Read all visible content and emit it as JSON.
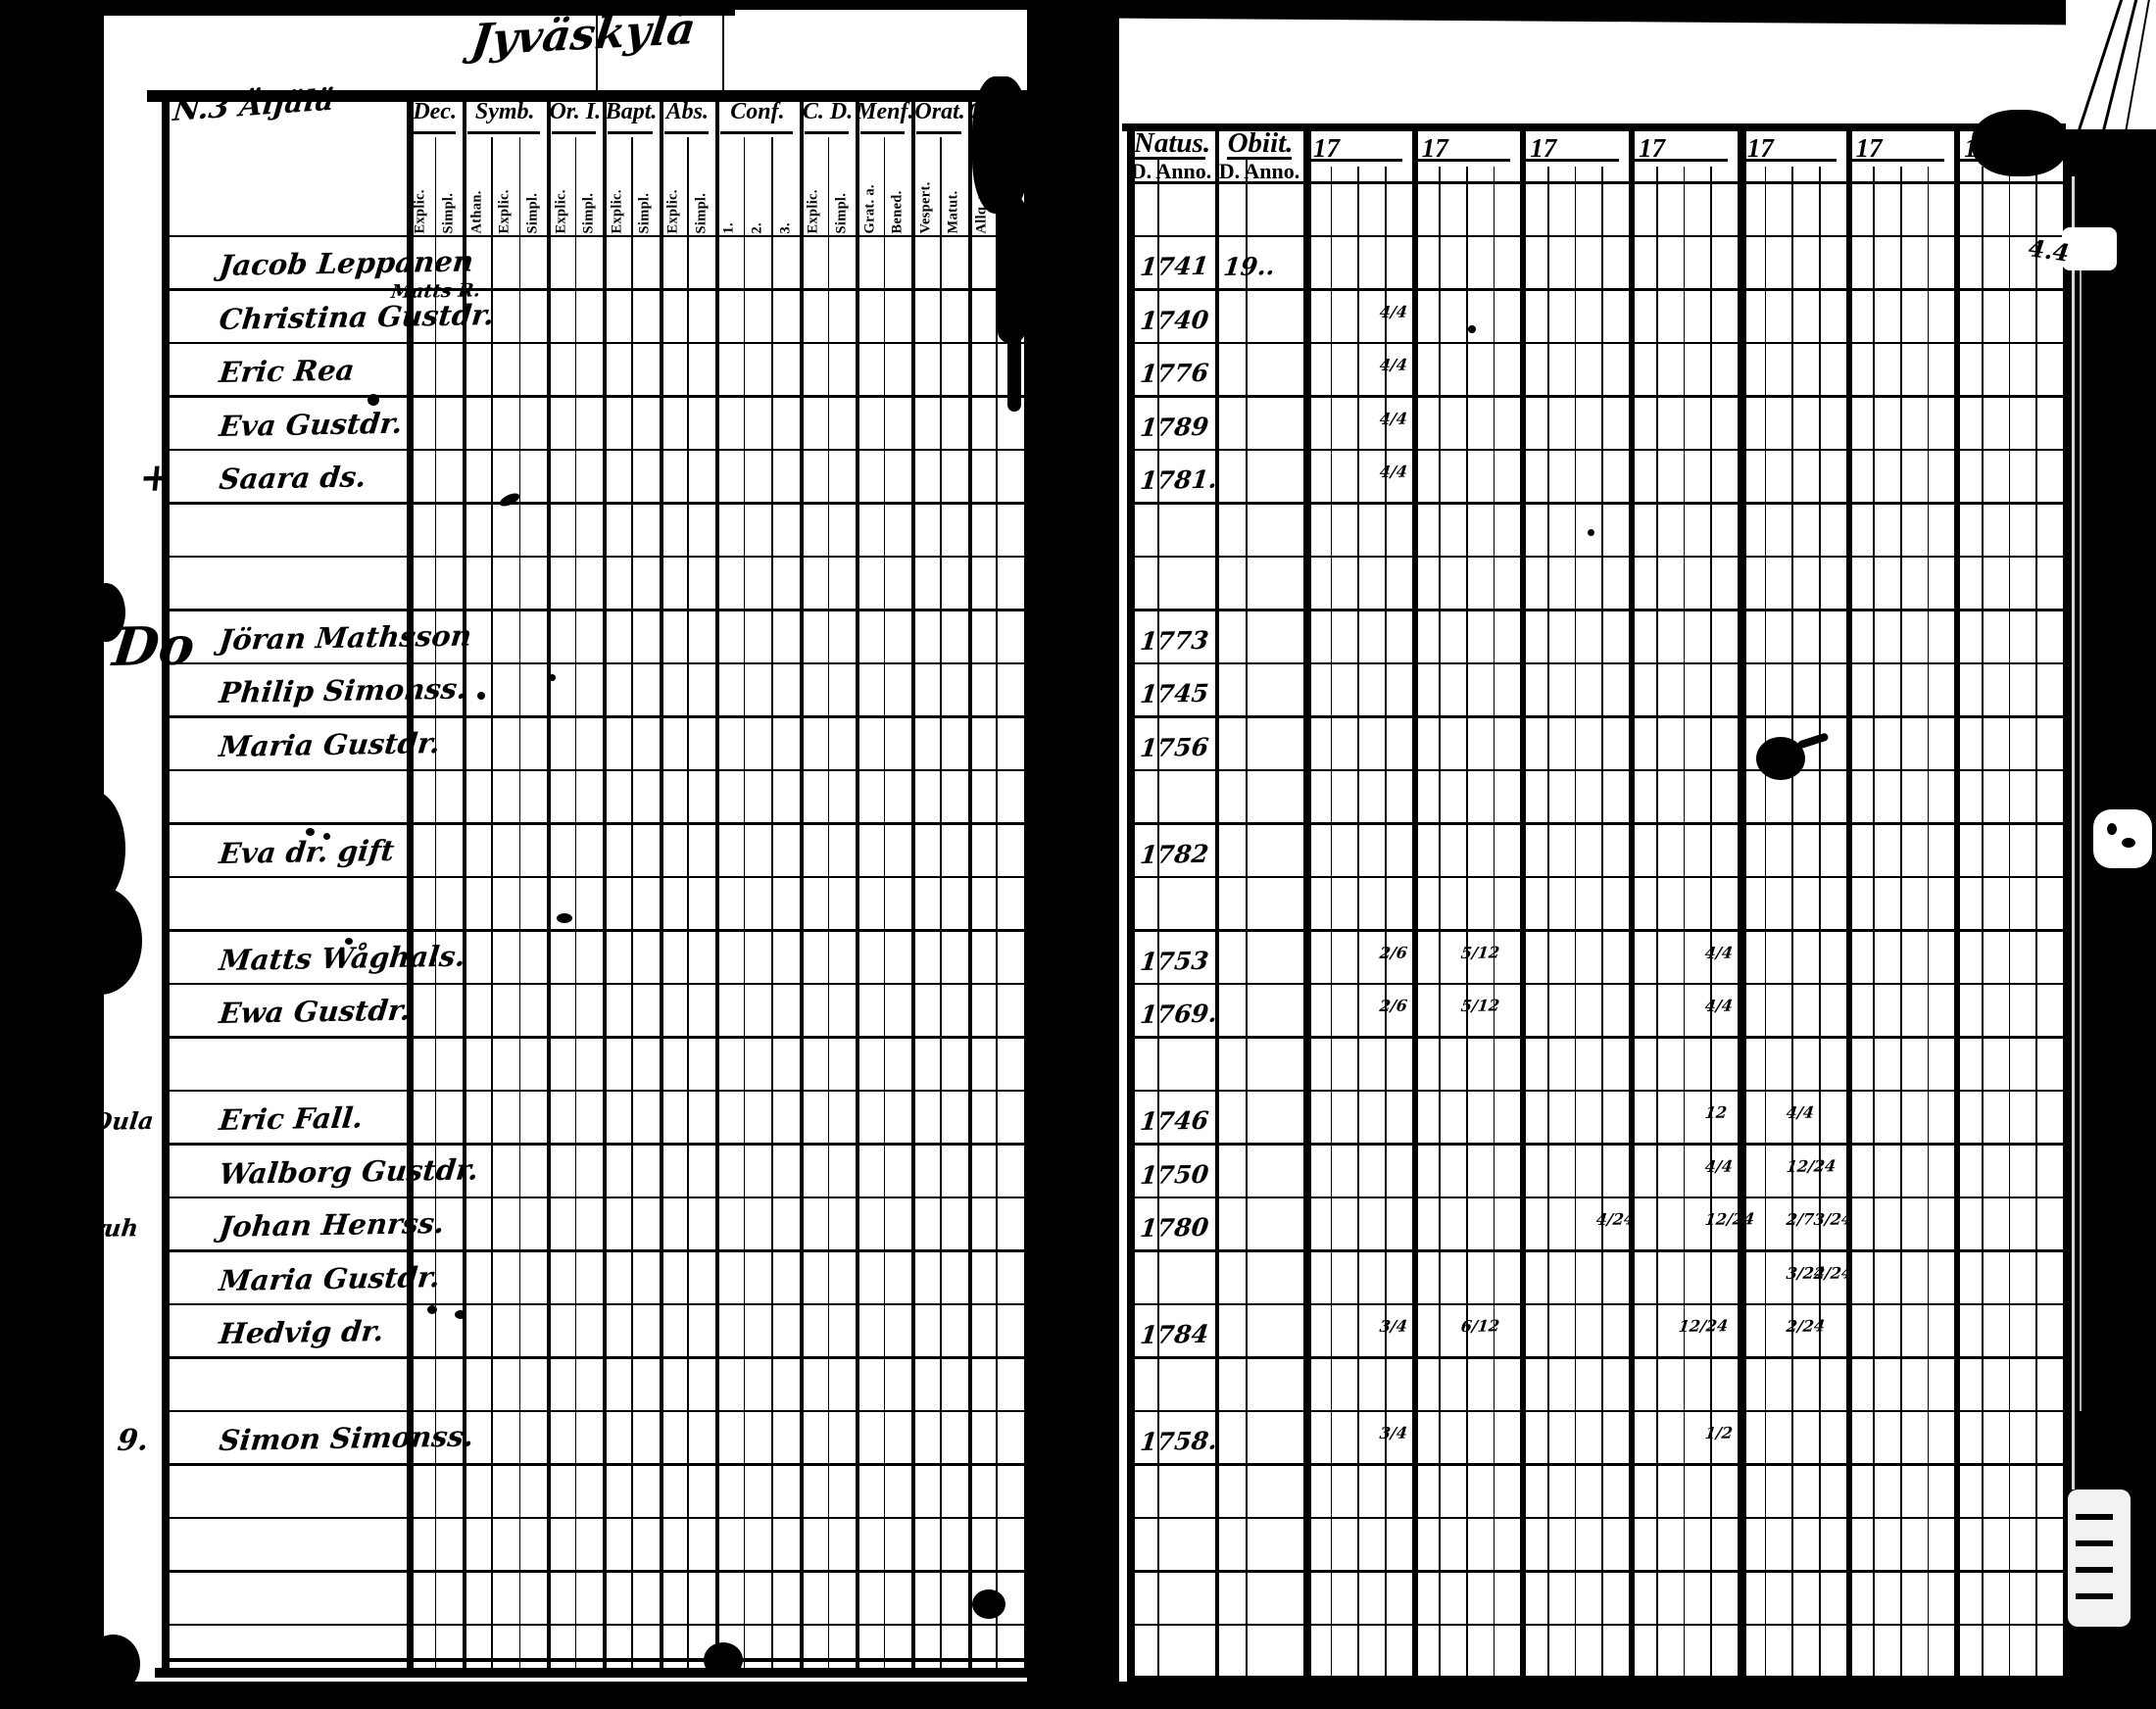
{
  "document": {
    "title_handwritten": "Jyväskylä",
    "left_page": {
      "section_label": "N.3 Äijälä",
      "column_groups": [
        {
          "label": "Dec.",
          "subs": [
            "Explic.",
            "Simpl."
          ]
        },
        {
          "label": "Symb.",
          "subs": [
            "Athan.",
            "Explic.",
            "Simpl."
          ]
        },
        {
          "label": "Or. I.",
          "subs": [
            "Explic.",
            "Simpl."
          ]
        },
        {
          "label": "Bapt.",
          "subs": [
            "Explic.",
            "Simpl."
          ]
        },
        {
          "label": "Abs.",
          "subs": [
            "Explic.",
            "Simpl."
          ]
        },
        {
          "label": "Conf.",
          "subs": [
            "1.",
            "2.",
            "3."
          ]
        },
        {
          "label": "C. D.",
          "subs": [
            "Explic.",
            "Simpl."
          ]
        },
        {
          "label": "Menf.",
          "subs": [
            "Grat. a.",
            "Bened."
          ]
        },
        {
          "label": "Orat.",
          "subs": [
            "Vespert.",
            "Matut."
          ]
        },
        {
          "label": "Quart.",
          "subs": [
            "Allq. m.",
            "Homil."
          ]
        }
      ],
      "entries": [
        {
          "row": 1,
          "name": "Jacob Leppanen"
        },
        {
          "row": 2,
          "name": "Christina Gustdr.",
          "note": "Matts R."
        },
        {
          "row": 3,
          "name": "Eric Rea"
        },
        {
          "row": 4,
          "name": "Eva Gustdr."
        },
        {
          "row": 5,
          "name": "Saara ds."
        },
        {
          "row": 8,
          "name": "Jöran Mathsson"
        },
        {
          "row": 9,
          "name": "Philip Simonss."
        },
        {
          "row": 10,
          "name": "Maria Gustdr."
        },
        {
          "row": 12,
          "name": "Eva dr. gift"
        },
        {
          "row": 14,
          "name": "Matts Wåghals."
        },
        {
          "row": 15,
          "name": "Ewa Gustdr."
        },
        {
          "row": 17,
          "name": "Eric Fall."
        },
        {
          "row": 18,
          "name": "Walborg Gustdr."
        },
        {
          "row": 19,
          "name": "Johan Henrss."
        },
        {
          "row": 20,
          "name": "Maria Gustdr."
        },
        {
          "row": 21,
          "name": "Hedvig dr."
        },
        {
          "row": 23,
          "name": "Simon Simonss."
        }
      ],
      "margin_marks": [
        {
          "row": 5,
          "text": "+"
        },
        {
          "row": 8,
          "text": "Do"
        },
        {
          "row": 17,
          "text": "Oula"
        },
        {
          "row": 19,
          "text": "ruh"
        },
        {
          "row": 23,
          "text": "9."
        }
      ]
    },
    "right_page": {
      "natus_label": "Natus.",
      "obiit_label": "Obiit.",
      "d_anno_label": "D. Anno.",
      "year_column_label": "17",
      "year_column_count": 7,
      "page_number": "122",
      "edge_note": "4.4",
      "entries": [
        {
          "row": 1,
          "natus": "1741",
          "obiit": "19.."
        },
        {
          "row": 2,
          "natus": "1740"
        },
        {
          "row": 3,
          "natus": "1776"
        },
        {
          "row": 4,
          "natus": "1789"
        },
        {
          "row": 5,
          "natus": "1781."
        },
        {
          "row": 8,
          "natus": "1773"
        },
        {
          "row": 9,
          "natus": "1745"
        },
        {
          "row": 10,
          "natus": "1756"
        },
        {
          "row": 12,
          "natus": "1782"
        },
        {
          "row": 14,
          "natus": "1753"
        },
        {
          "row": 15,
          "natus": "1769."
        },
        {
          "row": 17,
          "natus": "1746"
        },
        {
          "row": 18,
          "natus": "1750"
        },
        {
          "row": 19,
          "natus": "1780"
        },
        {
          "row": 21,
          "natus": "1784"
        },
        {
          "row": 23,
          "natus": "1758."
        }
      ],
      "cell_marks": [
        {
          "row": 2,
          "col": 0,
          "sub": 3,
          "text": "4/4"
        },
        {
          "row": 3,
          "col": 0,
          "sub": 3,
          "text": "4/4"
        },
        {
          "row": 4,
          "col": 0,
          "sub": 3,
          "text": "4/4"
        },
        {
          "row": 5,
          "col": 0,
          "sub": 3,
          "text": "4/4"
        },
        {
          "row": 14,
          "col": 0,
          "sub": 3,
          "text": "2/6"
        },
        {
          "row": 14,
          "col": 1,
          "sub": 2,
          "text": "5/12"
        },
        {
          "row": 14,
          "col": 3,
          "sub": 3,
          "text": "4/4"
        },
        {
          "row": 15,
          "col": 0,
          "sub": 3,
          "text": "2/6"
        },
        {
          "row": 15,
          "col": 1,
          "sub": 2,
          "text": "5/12"
        },
        {
          "row": 15,
          "col": 3,
          "sub": 3,
          "text": "4/4"
        },
        {
          "row": 17,
          "col": 3,
          "sub": 3,
          "text": "12"
        },
        {
          "row": 17,
          "col": 4,
          "sub": 2,
          "text": "4/4"
        },
        {
          "row": 18,
          "col": 3,
          "sub": 3,
          "text": "4/4"
        },
        {
          "row": 18,
          "col": 4,
          "sub": 2,
          "text": "12/24"
        },
        {
          "row": 19,
          "col": 2,
          "sub": 3,
          "text": "4/24"
        },
        {
          "row": 19,
          "col": 3,
          "sub": 3,
          "text": "12/24"
        },
        {
          "row": 19,
          "col": 4,
          "sub": 2,
          "text": "2/7"
        },
        {
          "row": 19,
          "col": 4,
          "sub": 3,
          "text": "3/24"
        },
        {
          "row": 20,
          "col": 4,
          "sub": 2,
          "text": "3/24"
        },
        {
          "row": 20,
          "col": 4,
          "sub": 3,
          "text": "2/24"
        },
        {
          "row": 21,
          "col": 0,
          "sub": 3,
          "text": "3/4"
        },
        {
          "row": 21,
          "col": 1,
          "sub": 2,
          "text": "6/12"
        },
        {
          "row": 21,
          "col": 3,
          "sub": 2,
          "text": "12/24"
        },
        {
          "row": 21,
          "col": 4,
          "sub": 2,
          "text": "2/24"
        },
        {
          "row": 23,
          "col": 0,
          "sub": 3,
          "text": "3/4"
        },
        {
          "row": 23,
          "col": 3,
          "sub": 3,
          "text": "1/2"
        }
      ]
    }
  }
}
